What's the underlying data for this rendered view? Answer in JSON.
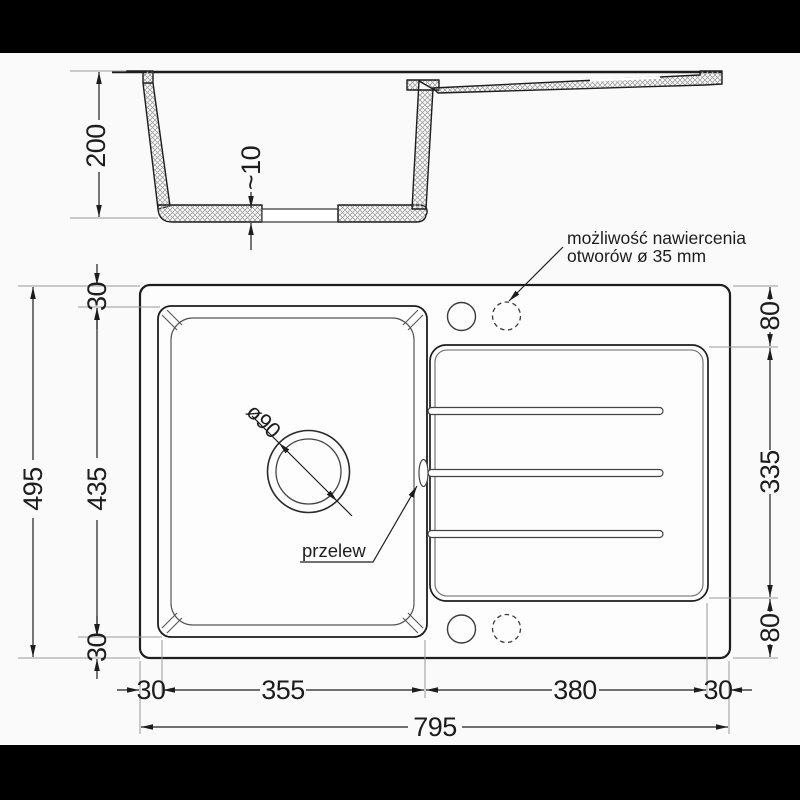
{
  "drawing_title": "sink-technical-drawing",
  "colors": {
    "line": "#1d1d1d",
    "light_line": "#999999",
    "hatch": "#a0a0a0",
    "paper": "#fafafa",
    "letterbox": "#000000"
  },
  "cross_section": {
    "depth": "200",
    "bottom_thickness": "~10"
  },
  "plan": {
    "overall_width": "795",
    "overall_height": "495",
    "left_top_margin": "30",
    "bowl_height": "435",
    "left_bottom_margin": "30",
    "right_top_margin": "80",
    "drainer_height": "335",
    "right_bottom_margin": "80",
    "bottom_left_margin": "30",
    "bowl_width": "355",
    "drainer_width": "380",
    "bottom_right_margin": "30"
  },
  "labels": {
    "drill_note_line1": "możliwość nawiercenia",
    "drill_note_line2": "otworów ø 35 mm",
    "overflow": "przelew",
    "drain_diameter": "ø90"
  }
}
